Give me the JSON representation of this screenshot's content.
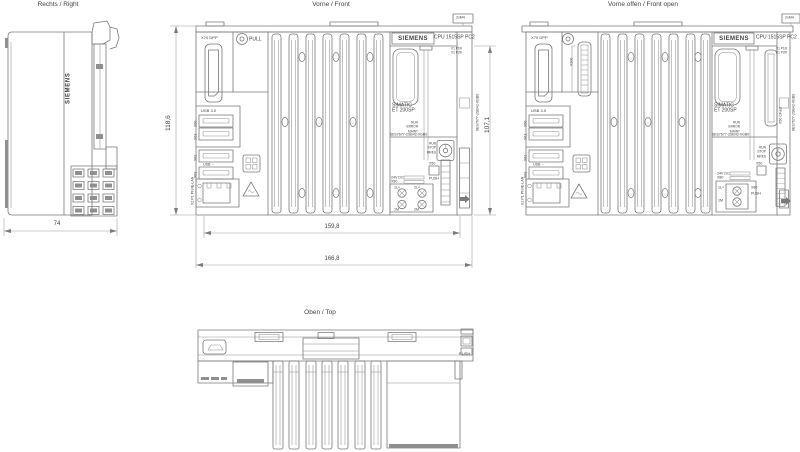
{
  "style": {
    "background": "#ffffff",
    "line_color": "#787878",
    "text_color": "#3f3f3f"
  },
  "views": {
    "right": {
      "title": "Rechts / Right"
    },
    "front": {
      "title": "Vorne / Front"
    },
    "front_open": {
      "title": "Vorne offen / Front open"
    },
    "top": {
      "title": "Oben / Top"
    }
  },
  "dimensions": {
    "right_width": "74",
    "front_height": "118,6",
    "front_right_height": "107,1",
    "front_width_inner": "159,8",
    "front_width_outer": "166,8"
  },
  "labels": {
    "brand": "SIEMENS",
    "cpu_model": "CPU 1515SP PC2",
    "product_line1": "SIMATIC",
    "product_line2": "ET 200SP",
    "article_number": "6ES7677-2SB42-0GB0",
    "displayport": "X70 DPP",
    "pull": "PULL",
    "usb3": "USB 3.0",
    "usb2": "USB ↔",
    "usb_port_1": "X60",
    "usb_port_2": "X61",
    "usb_port_3": "X62",
    "usb_port_4": "X63",
    "lan": "X2 P1 PN/IE-LAN",
    "header_connector": "X300",
    "cfast": "X50 CFast",
    "port_sub_1": "X1 P1R",
    "port_sub_2": "X1 P2R",
    "led_1": "RUN",
    "led_2": "ERROR",
    "led_3": "MAINT",
    "mode_1": "RUN",
    "mode_2": "STOP",
    "mode_3": "MRES",
    "card_slot": "X50",
    "push": "PUSH",
    "supply_1": "24V DC",
    "supply_2": "X80",
    "pin_1l": "1L+",
    "pin_2l": "2L+",
    "pin_1m": "1M",
    "pin_2m": "2M",
    "mount": "2xM4"
  }
}
